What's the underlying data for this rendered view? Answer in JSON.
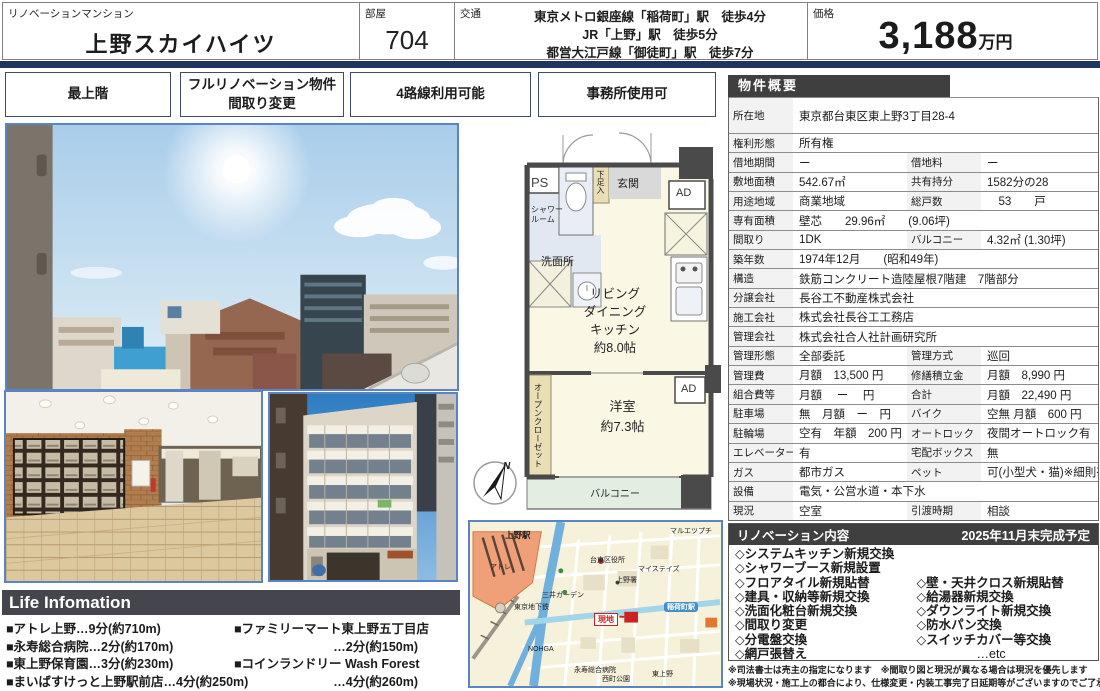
{
  "header": {
    "category_label": "リノベーションマンション",
    "property_name": "上野スカイハイツ",
    "room_label": "部屋",
    "room_number": "704",
    "transit_label": "交通",
    "transit_lines": [
      "東京メトロ銀座線「稲荷町」駅　徒歩4分",
      "JR「上野」駅　徒歩5分",
      "都営大江戸線「御徒町」駅　徒歩7分"
    ],
    "price_label": "価格",
    "price_value": "3,188",
    "price_unit": "万円"
  },
  "badges": [
    {
      "lines": [
        "最上階"
      ]
    },
    {
      "lines": [
        "フルリノベーション物件",
        "間取り変更"
      ]
    },
    {
      "lines": [
        "4路線利用可能"
      ]
    },
    {
      "lines": [
        "事務所使用可"
      ]
    }
  ],
  "floorplan": {
    "ps": "PS",
    "shower_room": "シャワー\nルーム",
    "shoe_box": "下足入",
    "entrance": "玄関",
    "ad_top": "AD",
    "washroom": "洗面所",
    "ldk": "リビング\nダイニング\nキッチン\n約8.0帖",
    "open_closet": "オープンクローゼット",
    "bedroom": "洋室\n約7.3帖",
    "ad_mid": "AD",
    "balcony": "バルコニー",
    "compass_n": "N"
  },
  "map": {
    "station_ueno": "上野駅",
    "label_atre": "アトレ",
    "label_subway": "東京地下鉄",
    "label_mitsui": "三井ガーデン",
    "label_taito_ward": "台東区役所",
    "label_police": "上野署",
    "label_mystays": "マイステイズ",
    "label_maruetsu": "マルエツプチ",
    "station_inaricho": "稲荷町駅",
    "site_marker": "現地",
    "label_nohga": "NOHGA",
    "label_eiju": "永寿総合病院",
    "label_nishimachi": "西町公園",
    "label_higashiueno": "東上野"
  },
  "overview": {
    "title": "物件概要",
    "rows": [
      {
        "tall": true,
        "cells": [
          {
            "l": "所在地",
            "v": "東京都台東区東上野3丁目28-4",
            "wide": true
          }
        ]
      },
      {
        "cells": [
          {
            "l": "権利形態",
            "v": "所有権",
            "wide": true
          }
        ]
      },
      {
        "cells": [
          {
            "l": "借地期間",
            "v": "ー"
          },
          {
            "l": "借地料",
            "v": "ー"
          }
        ]
      },
      {
        "cells": [
          {
            "l": "敷地面積",
            "v": "542.67㎡"
          },
          {
            "l": "共有持分",
            "v": "1582分の28"
          }
        ]
      },
      {
        "cells": [
          {
            "l": "用途地域",
            "v": "商業地域"
          },
          {
            "l": "総戸数",
            "v": "　53　　戸"
          }
        ]
      },
      {
        "cells": [
          {
            "l": "専有面積",
            "v": "壁芯　　29.96㎡　　(9.06坪)",
            "wide": true
          }
        ]
      },
      {
        "cells": [
          {
            "l": "間取り",
            "v": "1DK"
          },
          {
            "l": "バルコニー",
            "v": "4.32㎡ (1.30坪)"
          }
        ]
      },
      {
        "cells": [
          {
            "l": "築年数",
            "v": "1974年12月　　(昭和49年)",
            "wide": true
          }
        ]
      },
      {
        "cells": [
          {
            "l": "構造",
            "v": "鉄筋コンクリート造陸屋根7階建　7階部分",
            "wide": true
          }
        ]
      },
      {
        "cells": [
          {
            "l": "分譲会社",
            "v": "長谷工不動産株式会社",
            "wide": true
          }
        ]
      },
      {
        "cells": [
          {
            "l": "施工会社",
            "v": "株式会社長谷工工務店",
            "wide": true
          }
        ]
      },
      {
        "cells": [
          {
            "l": "管理会社",
            "v": "株式会社合人社計画研究所",
            "wide": true
          }
        ]
      },
      {
        "cells": [
          {
            "l": "管理形態",
            "v": "全部委託"
          },
          {
            "l": "管理方式",
            "v": "巡回"
          }
        ]
      },
      {
        "cells": [
          {
            "l": "管理費",
            "v": "月額　13,500 円"
          },
          {
            "l": "修繕積立金",
            "v": "月額　8,990 円"
          }
        ]
      },
      {
        "cells": [
          {
            "l": "組合費等",
            "v": "月額　 ー 　円"
          },
          {
            "l": "合計",
            "v": "月額　22,490 円"
          }
        ]
      },
      {
        "cells": [
          {
            "l": "駐車場",
            "v": "無　月額　ー　円"
          },
          {
            "l": "バイク",
            "v": "空無 月額　600 円"
          }
        ]
      },
      {
        "cells": [
          {
            "l": "駐輪場",
            "v": "空有　年額　200 円"
          },
          {
            "l": "オートロック",
            "v": "夜間オートロック有"
          }
        ]
      },
      {
        "cells": [
          {
            "l": "エレベーター",
            "v": "有"
          },
          {
            "l": "宅配ボックス",
            "v": "無"
          }
        ]
      },
      {
        "cells": [
          {
            "l": "ガス",
            "v": "都市ガス"
          },
          {
            "l": "ペット",
            "v": "可(小型犬・猫)※細則有"
          }
        ]
      },
      {
        "cells": [
          {
            "l": "設備",
            "v": "電気・公営水道・本下水",
            "wide": true
          }
        ]
      },
      {
        "cells": [
          {
            "l": "現況",
            "v": "空室"
          },
          {
            "l": "引渡時期",
            "v": "相談"
          }
        ]
      }
    ]
  },
  "renovation": {
    "title": "リノベーション内容",
    "deadline": "2025年11月末完成予定",
    "items_left": [
      "◇システムキッチン新規交換",
      "◇シャワーブース新規設置",
      "◇フロアタイル新規貼替",
      "◇建具・収納等新規交換",
      "◇洗面化粧台新規交換",
      "◇間取り変更",
      "◇分電盤交換",
      "◇網戸張替え"
    ],
    "items_right": [
      "",
      "",
      "◇壁・天井クロス新規貼替",
      "◇給湯器新規交換",
      "◇ダウンライト新規交換",
      "◇防水パン交換",
      "◇スイッチカバー等交換",
      "…etc"
    ]
  },
  "notes": [
    "※司法書士は売主の指定になります　※間取り図と現況が異なる場合は現況を優先します",
    "※現場状況・施工上の都合により、仕様変更・内装工事完了日延期等がございますのでご了承ください"
  ],
  "life_info": {
    "title": "Life Infomation",
    "left_items": [
      "■アトレ上野…9分(約710m)",
      "■永寿総合病院…2分(約170m)",
      "■東上野保育園…3分(約230m)",
      "■まいばすけっと上野駅前店…4分(約250m)"
    ],
    "right_items": [
      "■ファミリーマート東上野五丁目店",
      "…2分(約150m)",
      "■コインランドリー Wash Forest",
      "…4分(約260m)"
    ]
  }
}
